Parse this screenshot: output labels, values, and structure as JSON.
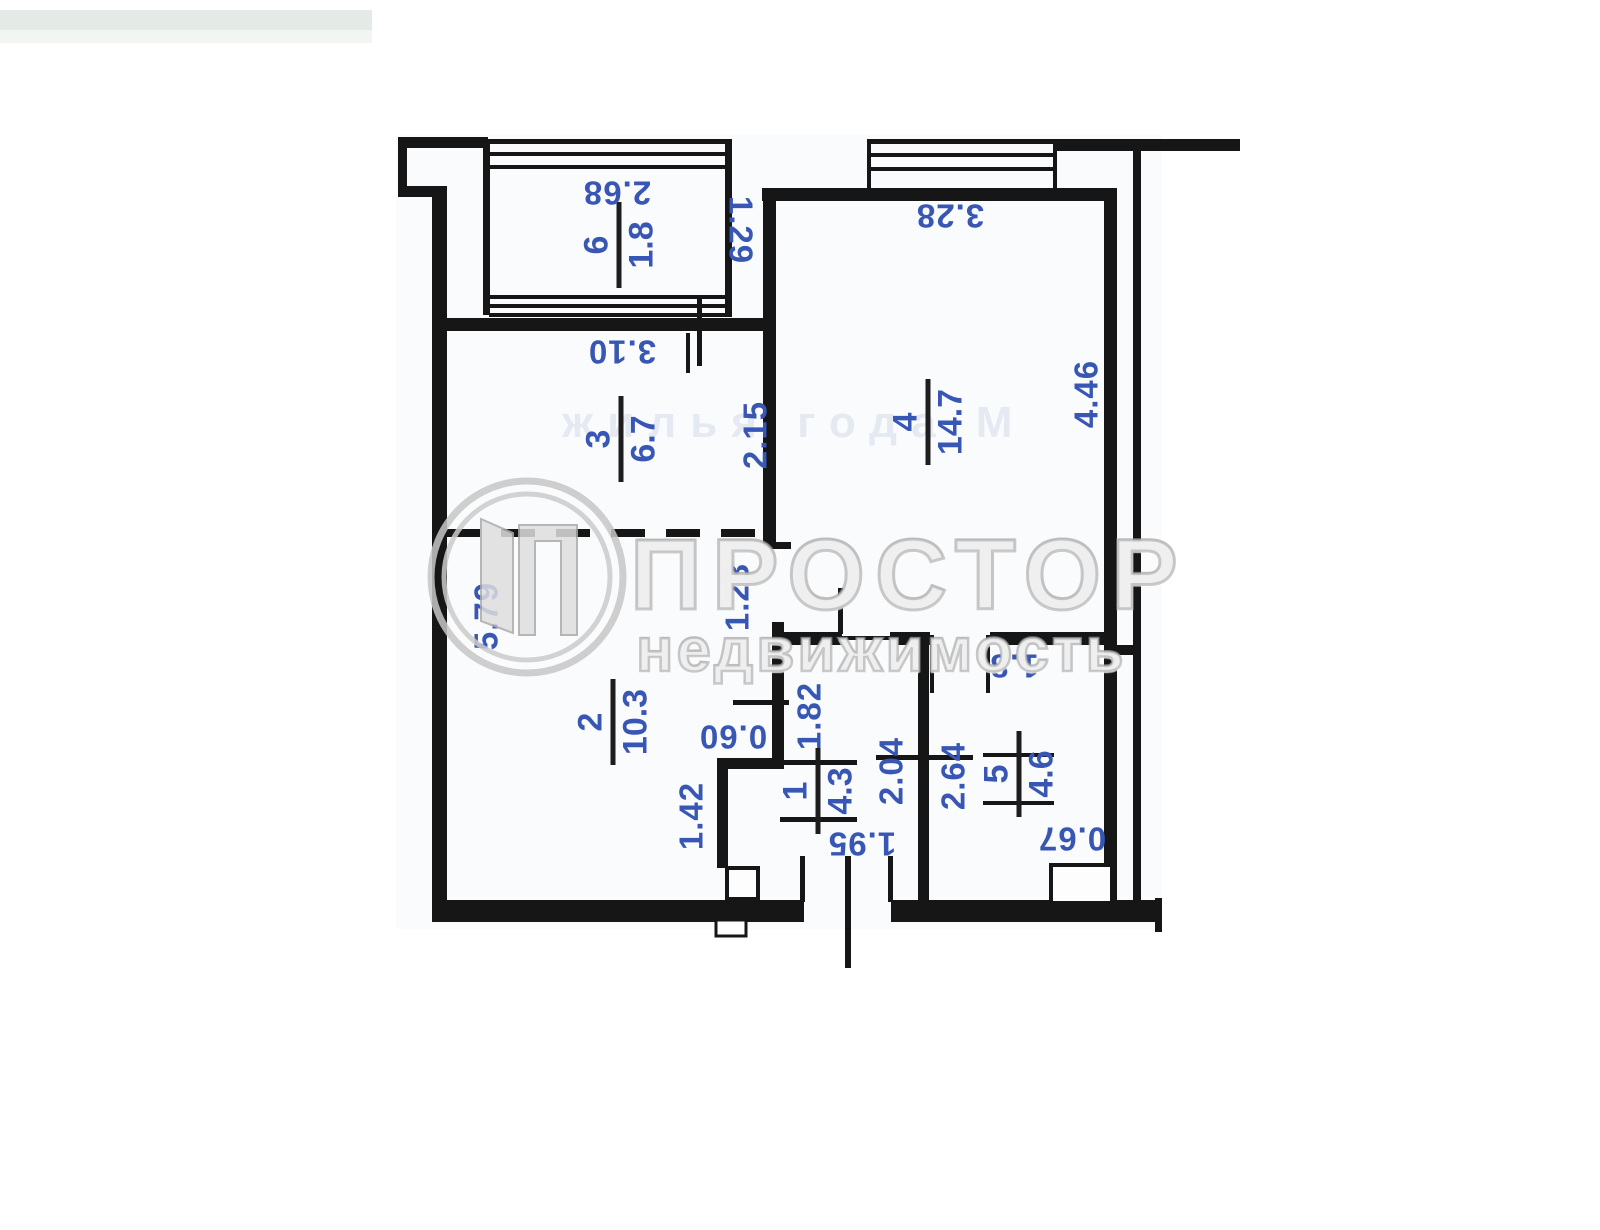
{
  "page": {
    "type": "scanned-floor-plan",
    "scan_strip_color": "#e4ebe6",
    "wall_color": "#161616",
    "dimension_color": "#3857b5",
    "ghost_text": "жилья года М"
  },
  "watermark": {
    "brand": "ПРОСТОР",
    "subtitle": "недвижимость",
    "logo": "door-in-circle-logo",
    "color": "#d9d9d9"
  },
  "plan": {
    "rooms": [
      {
        "number": "1",
        "area": "4.3"
      },
      {
        "number": "2",
        "area": "10.3"
      },
      {
        "number": "3",
        "area": "6.7"
      },
      {
        "number": "4",
        "area": "14.7"
      },
      {
        "number": "5",
        "area": "4.6"
      },
      {
        "number": "6",
        "area": "1.8"
      }
    ],
    "dimensions": [
      {
        "text": "2.68"
      },
      {
        "text": "1.29"
      },
      {
        "text": "3.10"
      },
      {
        "text": "2.15"
      },
      {
        "text": "3.28"
      },
      {
        "text": "4.46"
      },
      {
        "text": "5.79"
      },
      {
        "text": "1.23"
      },
      {
        "text": "0.60"
      },
      {
        "text": "1.82"
      },
      {
        "text": "1.8"
      },
      {
        "text": "2.04"
      },
      {
        "text": "2.64"
      },
      {
        "text": "1.42"
      },
      {
        "text": "1.95"
      },
      {
        "text": "0.67"
      }
    ]
  }
}
